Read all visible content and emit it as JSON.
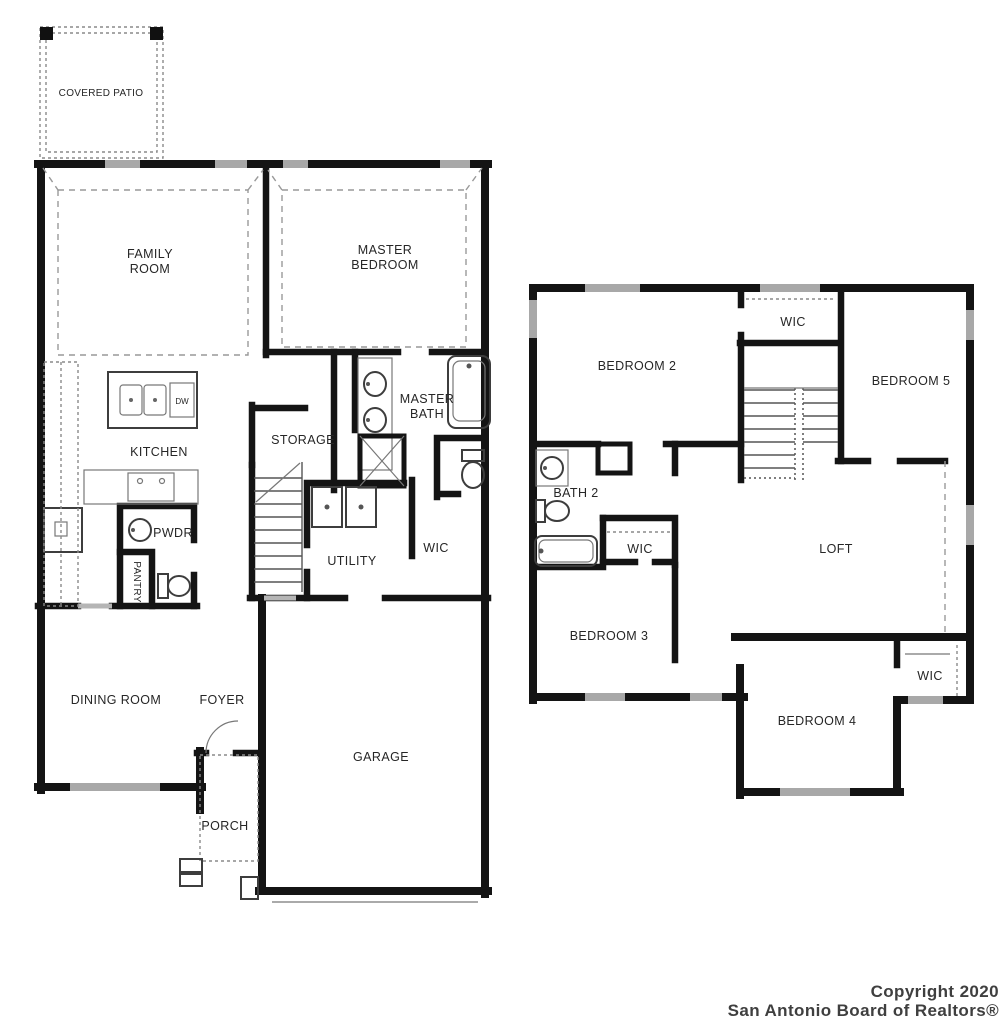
{
  "first_floor": {
    "covered_patio": "COVERED PATIO",
    "family_room_line1": "FAMILY",
    "family_room_line2": "ROOM",
    "master_bedroom_line1": "MASTER",
    "master_bedroom_line2": "BEDROOM",
    "kitchen": "KITCHEN",
    "storage": "STORAGE",
    "master_bath_line1": "MASTER",
    "master_bath_line2": "BATH",
    "powder": "PWDR",
    "pantry": "PANTRY",
    "utility": "UTILITY",
    "wic": "WIC",
    "dining_room": "DINING ROOM",
    "foyer": "FOYER",
    "porch": "PORCH",
    "garage": "GARAGE",
    "dishwasher": "DW"
  },
  "second_floor": {
    "bedroom_2": "BEDROOM 2",
    "wic_upper": "WIC",
    "bedroom_5": "BEDROOM 5",
    "bath_2": "BATH 2",
    "wic_middle": "WIC",
    "loft": "LOFT",
    "bedroom_3": "BEDROOM 3",
    "wic_lower": "WIC",
    "bedroom_4": "BEDROOM 4"
  },
  "copyright": {
    "line1": "Copyright 2020",
    "line2": "San Antonio Board of Realtors®"
  },
  "colors": {
    "wall": "#141414",
    "window": "#a8a8a8",
    "dashed_line": "#999999",
    "label_text": "#262626",
    "copyright_text": "#3f3f3f",
    "background": "#ffffff"
  }
}
